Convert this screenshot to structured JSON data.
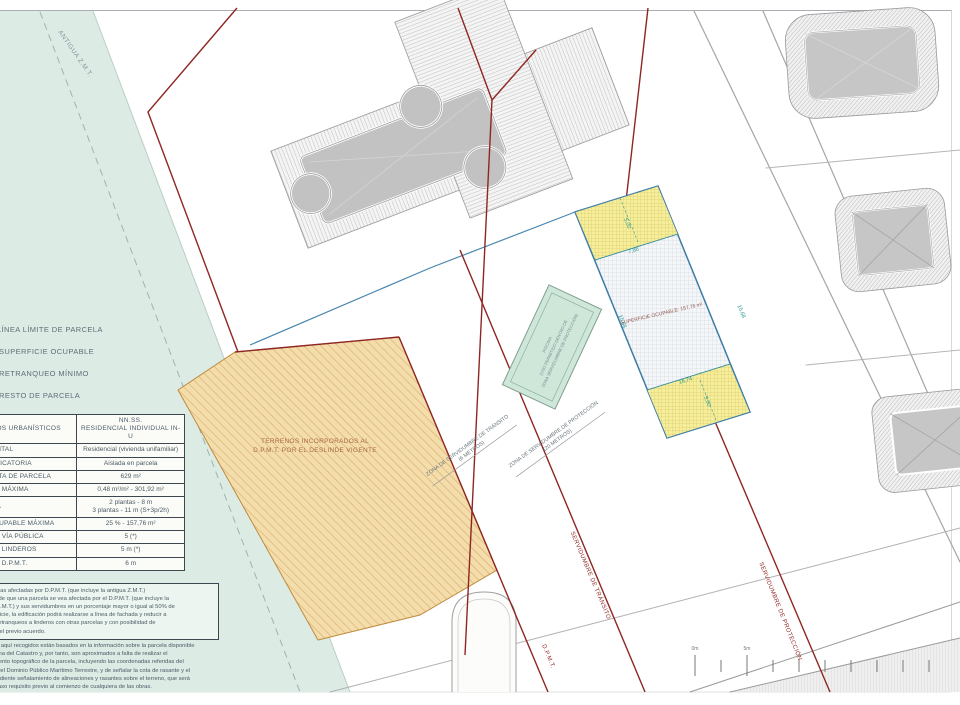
{
  "plan": {
    "antigua_zmt_label": "ANTIGUA Z.M.T.",
    "terrenos_line1": "TERRENOS INCORPORADOS AL",
    "terrenos_line2": "D.P.M.T. POR EL DESLINDE VIGENTE",
    "piscina_line1": "PISCINA",
    "piscina_line2": "(USO PERMITIDO DENTRO DE",
    "piscina_line3": "ZONA SERVIDUMBRE DE PROTECCIÓN)",
    "superficie_ocupable_label": "SUPERFICIE OCUPABLE: 157,76 m²",
    "zona_transito_line1": "ZONA DE SERVIDUMBRE DE TRÁNSITO",
    "zona_transito_line2": "(6 METROS)",
    "zona_proteccion_line1": "ZONA DE SERVIDUMBRE DE PROTECCIÓN",
    "zona_proteccion_line2": "(20 METROS)",
    "servidumbre_transito_label": "SERVIDUMBRE DE TRÁNSITO",
    "dpmt_label": "D.P.M.T.",
    "servidumbre_proteccion_label": "SERVIDUMBRE DE PROTECCIÓN",
    "dims": {
      "setback_top": "5,00",
      "top_width": "7,86",
      "side_left": "15,68",
      "side_right": "15,68",
      "bottom_width": "16,74",
      "setback_bottom": "5,00"
    },
    "scale": {
      "tick0": "0m",
      "tick5": "5m"
    }
  },
  "legend": {
    "items": [
      {
        "label": "LÍNEA LÍMITE DE PARCELA"
      },
      {
        "label": "SUPERFICIE OCUPABLE"
      },
      {
        "label": "RETRANQUEO MÍNIMO"
      },
      {
        "label": "RESTO DE PARCELA"
      }
    ]
  },
  "table": {
    "header_left": "PARÁMETROS URBANÍSTICOS",
    "header_right1": "NN.SS.",
    "header_right2": "RESIDENCIAL INDIVIDUAL IN-U",
    "rows": [
      {
        "label": "USO FUNDAMENTAL",
        "value": "Residencial (vivienda unifamiliar)",
        "value2": ""
      },
      {
        "label": "TIPOLOGÍA EDIFICATORIA",
        "value": "Aislada en parcela",
        "value2": ""
      },
      {
        "label": "SUPERFICIE NETA DE PARCELA",
        "value": "629 m²",
        "value2": ""
      },
      {
        "label": "EDIFICABILIDAD MÁXIMA",
        "value": "0,48 m²/m² - 301,92 m²",
        "value2": ""
      },
      {
        "label": "ALTURA MÁXIMA",
        "value": "2 plantas - 8 m",
        "value2": "3 plantas - 11 m (S+3p/2h)"
      },
      {
        "label": "SUPERFICIE OCUPABLE MÁXIMA",
        "value": "25 % - 157,76 m²",
        "value2": ""
      },
      {
        "label": "RETRANQUEO A VÍA PÚBLICA",
        "value": "5 (*)",
        "value2": ""
      },
      {
        "label": "RETRANQUEO A LINDEROS",
        "value": "5 m (*)",
        "value2": ""
      },
      {
        "label": "RETRANQUEO A D.P.M.T.",
        "value": "6 m",
        "value2": ""
      }
    ]
  },
  "notes": {
    "box_lines": [
      "(*) Parcelas afectadas por D.P.M.T. (que incluye la antigua Z.M.T.)",
      "En caso de que una parcela se vea afectada por el D.P.M.T. (que incluye la",
      "antigua Z.M.T.) y sus servidumbres en un porcentaje mayor o igual al 50% de",
      "su superficie, la edificación podrá realizarse a línea de fachada y reducir a",
      "3 m los retranqueos a linderos con otras parcelas y con posibilidad de",
      "alcanzar el previo acuerdo."
    ],
    "par_lines": [
      "Los datos aquí recogidos están basados en la información sobre la parcela disponible",
      "en la oficina del Catastro y, por tanto, son aproximados a falta de realizar el",
      "levantamiento topográfico de la parcela, incluyendo las coordenadas referidas del",
      "deslinde del Dominio Público Marítimo Terrestre, y de señalar la cota de rasante y el",
      "correspondiente señalamiento de alineaciones y rasantes sobre el terreno, que será",
      "en todo caso requisito previo al comienzo de cualquiera de las obras."
    ]
  },
  "colors": {
    "sea_green": "#dcebe4",
    "orange_fill": "#f3ddab",
    "yellow_fill": "#f6ee9b",
    "band_blue": "#3d7ca6",
    "red_line": "#8e2723",
    "teal_dim": "#2f9b96",
    "building_gray": "#c4c4c4",
    "pool_green": "#cfe7d9"
  }
}
